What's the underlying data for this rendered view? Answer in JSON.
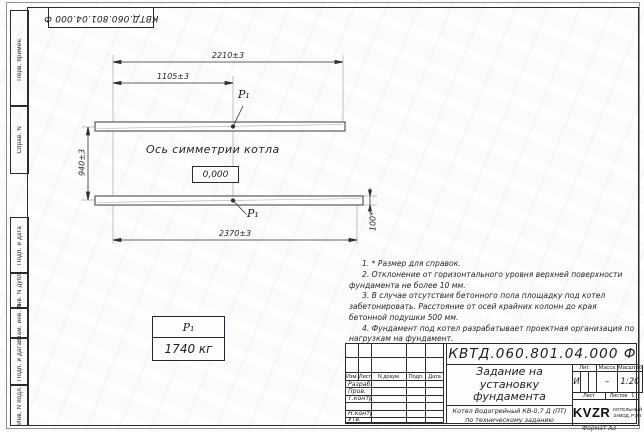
{
  "sheet": {
    "format_note": "Формат А3",
    "designation_flipped": "КВТД.060.801.04.000 Ф",
    "side_labels": [
      "Перв. примен.",
      "Справ. N",
      "Подп. и дата",
      "Инв. N дубл.",
      "Взам. инв. N",
      "Подп. и дата",
      "Инв. N подл."
    ]
  },
  "drawing": {
    "dims": {
      "top_overall": "2210±3",
      "top_half": "1105±3",
      "height_between": "940±3",
      "bottom_overall": "2370±3",
      "beam_width": "100*"
    },
    "axis_label": "Ось симметрии котла",
    "level_mark": "0,000",
    "point_load_top": "P₁",
    "point_load_bottom": "P₁"
  },
  "load_table": {
    "symbol": "P₁",
    "value": "1740 кг"
  },
  "notes": [
    "1. * Размер для справок.",
    "2. Отклонение от горизонтального уровня верхней поверхности фундамента не более 10 мм.",
    "3. В случае отсутствия бетонного пола площадку под котел забетонировать. Расстояние от осей крайних колонн до края бетонной подушки 500 мм.",
    "4. Фундамент под котел разрабатывает проектная организация по нагрузкам на фундамент."
  ],
  "title_block": {
    "designation": "КВТД.060.801.04.000  Ф",
    "doc_title": "Задание на установку фундамента",
    "product_line1": "Котел Водогрейный КВ-0,7 Д (ПТ)",
    "product_line2": "по техническому заданию",
    "cols": {
      "izm": "Изм.",
      "list": "Лист",
      "doc": "N докум.",
      "podp": "Подп.",
      "data": "Дата"
    },
    "rows": [
      "Разраб.",
      "Пров.",
      "Т.контр.",
      "",
      "Н.контр.",
      "Утв."
    ],
    "lit": {
      "label": "Лит.",
      "value": "И"
    },
    "mass": {
      "label": "Масса",
      "value": "–"
    },
    "scale": {
      "label": "Масштаб",
      "value": "1:20"
    },
    "sheet_col": {
      "label": "Лист",
      "value": ""
    },
    "sheets_col": {
      "label": "Листов",
      "value": "1"
    },
    "company": {
      "logo": "KVZR",
      "line1": "КОТЕЛЬНЫЙ",
      "line2": "ЗАВОД, РЭП",
      "logo_color": "#111111"
    }
  }
}
